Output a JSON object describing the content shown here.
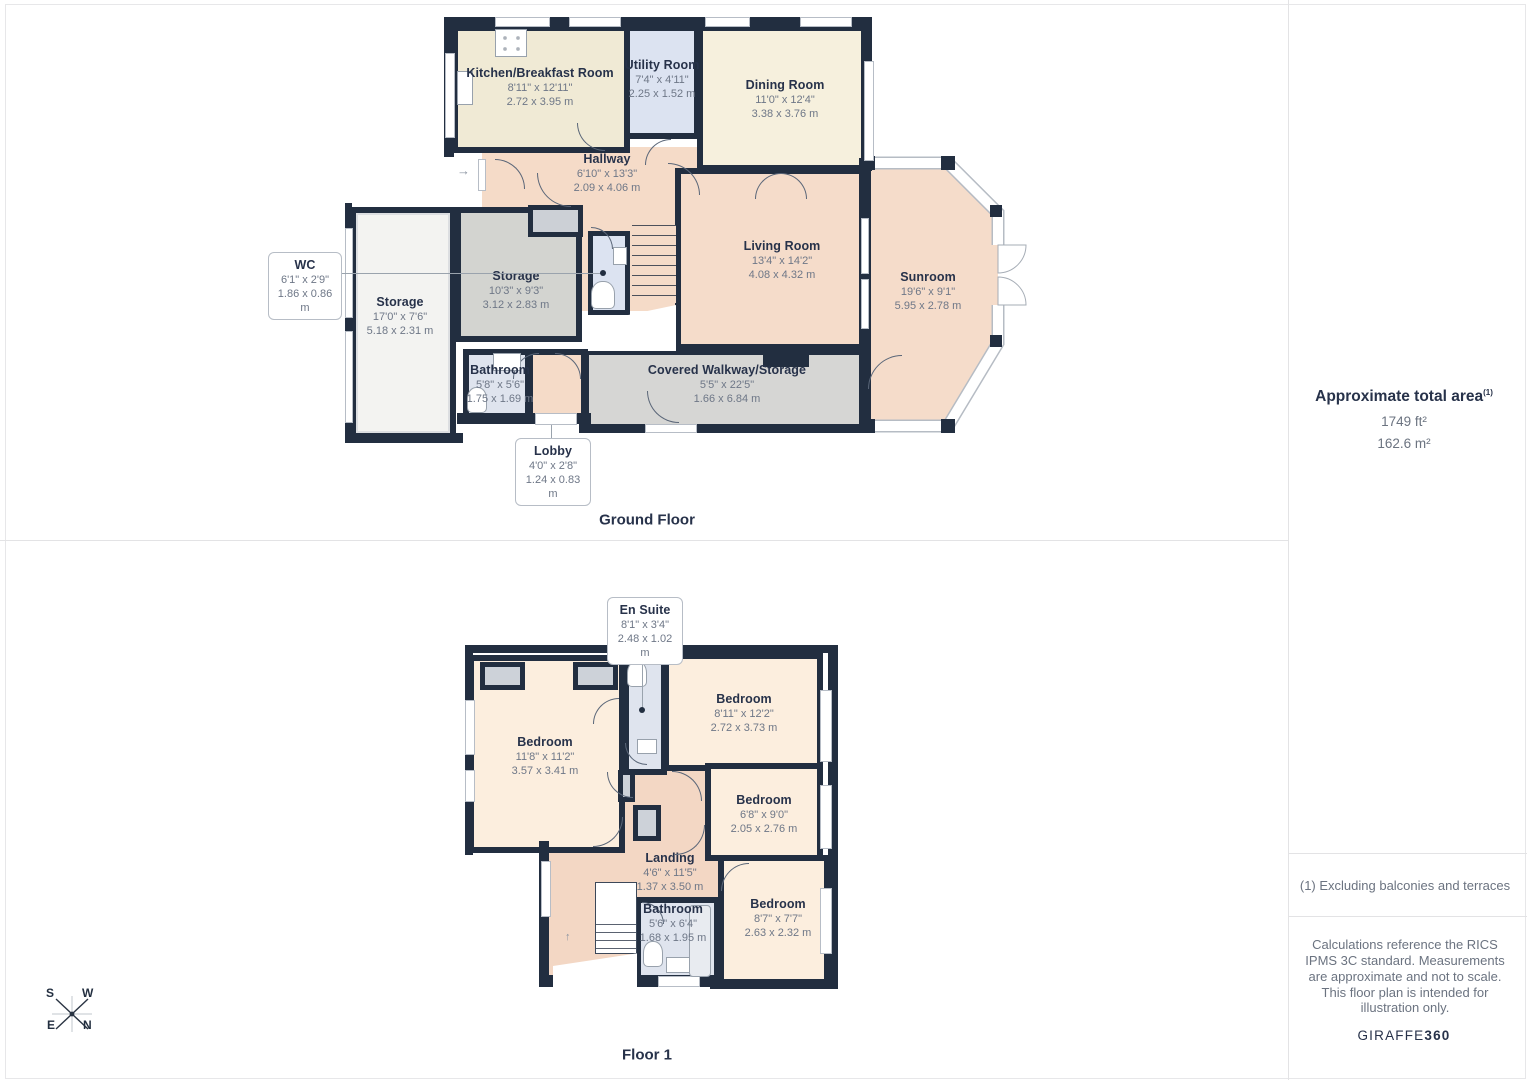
{
  "ground_floor": {
    "title": "Ground Floor",
    "rooms": [
      {
        "name": "Kitchen/Breakfast Room",
        "dims_ft": "8'11\" x 12'11\"",
        "dims_m": "2.72 x 3.95 m"
      },
      {
        "name": "Utility Room",
        "dims_ft": "7'4\" x 4'11\"",
        "dims_m": "2.25 x 1.52 m"
      },
      {
        "name": "Dining Room",
        "dims_ft": "11'0\" x 12'4\"",
        "dims_m": "3.38 x 3.76 m"
      },
      {
        "name": "Hallway",
        "dims_ft": "6'10\" x 13'3\"",
        "dims_m": "2.09 x 4.06 m"
      },
      {
        "name": "WC",
        "dims_ft": "6'1\" x 2'9\"",
        "dims_m": "1.86 x 0.86 m"
      },
      {
        "name": "Storage",
        "dims_ft": "17'0\" x 7'6\"",
        "dims_m": "5.18 x 2.31 m"
      },
      {
        "name": "Storage",
        "dims_ft": "10'3\" x 9'3\"",
        "dims_m": "3.12 x 2.83 m"
      },
      {
        "name": "Living Room",
        "dims_ft": "13'4\" x 14'2\"",
        "dims_m": "4.08 x 4.32 m"
      },
      {
        "name": "Sunroom",
        "dims_ft": "19'6\" x 9'1\"",
        "dims_m": "5.95 x 2.78 m"
      },
      {
        "name": "Bathroom",
        "dims_ft": "5'8\" x 5'6\"",
        "dims_m": "1.75 x 1.69 m"
      },
      {
        "name": "Covered Walkway/Storage",
        "dims_ft": "5'5\" x 22'5\"",
        "dims_m": "1.66 x 6.84 m"
      },
      {
        "name": "Lobby",
        "dims_ft": "4'0\" x 2'8\"",
        "dims_m": "1.24 x 0.83 m"
      }
    ]
  },
  "floor_1": {
    "title": "Floor 1",
    "rooms": [
      {
        "name": "En Suite",
        "dims_ft": "8'1\" x 3'4\"",
        "dims_m": "2.48 x 1.02 m"
      },
      {
        "name": "Bedroom",
        "dims_ft": "11'8\" x 11'2\"",
        "dims_m": "3.57 x 3.41 m"
      },
      {
        "name": "Bedroom",
        "dims_ft": "8'11\" x 12'2\"",
        "dims_m": "2.72 x 3.73 m"
      },
      {
        "name": "Bedroom",
        "dims_ft": "6'8\" x 9'0\"",
        "dims_m": "2.05 x 2.76 m"
      },
      {
        "name": "Landing",
        "dims_ft": "4'6\" x 11'5\"",
        "dims_m": "1.37 x 3.50 m"
      },
      {
        "name": "Bathroom",
        "dims_ft": "5'6\" x 6'4\"",
        "dims_m": "1.68 x 1.95 m"
      },
      {
        "name": "Bedroom",
        "dims_ft": "8'7\" x 7'7\"",
        "dims_m": "2.63 x 2.32 m"
      }
    ]
  },
  "compass": {
    "s": "S",
    "w": "W",
    "e": "E",
    "n": "N"
  },
  "icons": {
    "entry_arrow": "→",
    "stairs_up_arrow": "↑"
  },
  "sidebar": {
    "total_area_title": "Approximate total area",
    "total_area_note_ref": "(1)",
    "area_ft": "1749 ft²",
    "area_m": "162.6 m²",
    "footnote": "(1) Excluding balconies and terraces",
    "disclaimer": "Calculations reference the RICS IPMS 3C standard. Measurements are approximate and not to scale. This floor plan is intended for illustration only.",
    "brand_name": "GIRAFFE",
    "brand_suffix": "360"
  },
  "colors": {
    "wall": "#222e40",
    "kitchen": "#f0ead5",
    "dining": "#f6f0dd",
    "cream_bedroom": "#fceede",
    "pink": "#f5dbc8",
    "blue": "#dfe4ee",
    "gray": "#d3d4d0",
    "white_room": "#f3f3f1",
    "walkway": "#d6d6d4"
  }
}
